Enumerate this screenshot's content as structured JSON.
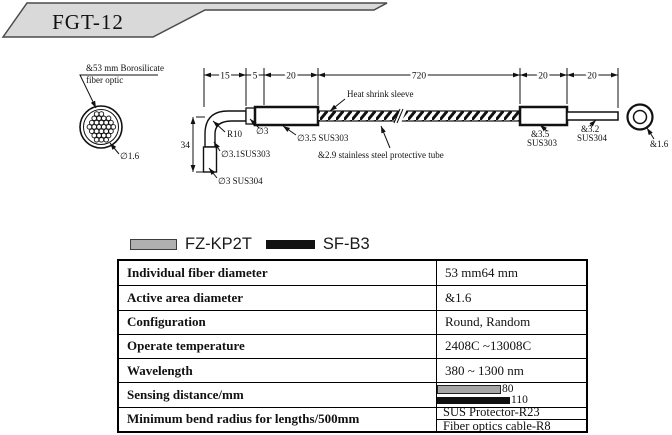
{
  "title": "FGT-12",
  "drawing": {
    "fiber_note": {
      "line1": "&53 mm Borosilicate",
      "line2": "fiber optic"
    },
    "left_circle_label": "∅1.6",
    "dimensions": {
      "seg1": "15",
      "seg2": "5",
      "seg3": "20",
      "seg4": "720",
      "seg5": "20",
      "seg6": "20",
      "vertical": "34"
    },
    "callouts": {
      "bend_radius": "R10",
      "tube_d3": "∅3",
      "sleeve_d35": "∅3.5 SUS303",
      "vertical_d31": "∅3.1SUS303",
      "tip_d3": "∅3 SUS304",
      "heat_shrink": "Heat shrink sleeve",
      "protective_tube": "&2.9 stainless steel protective tube",
      "right_d35_line1": "&3.5",
      "right_d35_line2": "SUS303",
      "right_d32_line1": "&3.2",
      "right_d32_line2": "SUS304",
      "end_view_d16": "&1.6"
    }
  },
  "legend": {
    "item1": {
      "label": "FZ-KP2T",
      "color": "#b0b0b0"
    },
    "item2": {
      "label": "SF-B3",
      "color": "#121212"
    }
  },
  "table": {
    "rows": [
      {
        "label": "Individual fiber diameter",
        "value": "53 mm64 mm"
      },
      {
        "label": "Active area diameter",
        "value": "&1.6"
      },
      {
        "label": "Configuration",
        "value": "Round, Random"
      },
      {
        "label": "Operate temperature",
        "value": "2408C ~13008C"
      },
      {
        "label": "Wavelength",
        "value": "380 ~ 1300 nm"
      },
      {
        "label": "Sensing distance/mm",
        "bars": {
          "gray": {
            "value": "80",
            "series": "FZ-KP2T"
          },
          "black": {
            "value": "110",
            "series": "SF-B3"
          }
        }
      },
      {
        "label": "Minimum bend radius for lengths/500mm",
        "value_line1": "SUS Protector-R23",
        "value_line2": "Fiber optics cable-R8"
      }
    ]
  }
}
